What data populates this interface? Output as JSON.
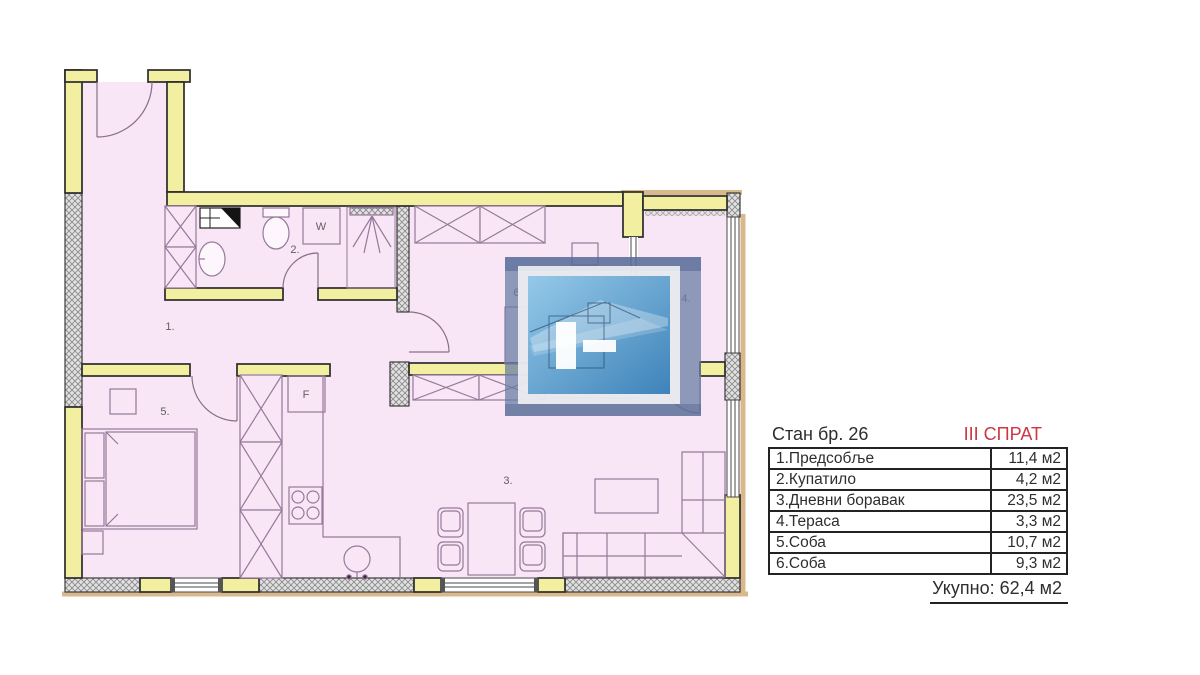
{
  "header": {
    "apartment_label": "Стан бр. 26",
    "floor_label": "III СПРАТ"
  },
  "area_table": {
    "rows": [
      {
        "name": "1.Предсобље",
        "area": "11,4 м2"
      },
      {
        "name": "2.Купатило",
        "area": "4,2 м2"
      },
      {
        "name": "3.Дневни боравак",
        "area": "23,5 м2"
      },
      {
        "name": "4.Тераса",
        "area": "3,3 м2"
      },
      {
        "name": "5.Соба",
        "area": "10,7 м2"
      },
      {
        "name": "6.Соба",
        "area": "9,3 м2"
      }
    ],
    "total_label": "Укупно: 62,4 м2"
  },
  "plan": {
    "labels": {
      "hallway": "1.",
      "bathroom": "2.",
      "living_room": "3.",
      "terrace": "4.",
      "bedroom_5": "5.",
      "bedroom_6": "6.",
      "washing_machine": "W",
      "fridge": "F"
    }
  },
  "colors": {
    "wall": "#f2efa1",
    "floor": "#f8e6f6",
    "accent_red": "#cd3642",
    "furniture": "#96799a",
    "trim": "#d9b98b",
    "watermark_blue": "#4a90c8"
  }
}
